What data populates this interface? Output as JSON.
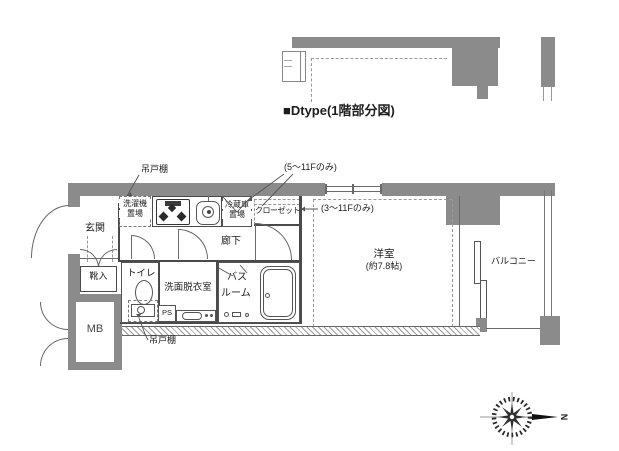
{
  "title": "■Dtype(1階部分図)",
  "colors": {
    "wall": "#8b8b8b",
    "line": "#4a4a4a",
    "accent_ink": "#222222"
  },
  "rooms": {
    "genkan": "玄関",
    "shoe_box": "靴入",
    "meter_box": "MB",
    "toilet": "トイレ",
    "washroom": "洗面脱衣室",
    "bathroom_line1": "バス",
    "bathroom_line2": "ルーム",
    "corridor": "廊下",
    "western_room": "洋室",
    "western_room_size": "(約7.8帖)",
    "balcony": "バルコニー",
    "closet": "クローゼット",
    "fridge_line1": "冷蔵庫",
    "fridge_line2": "置場",
    "washer_line1": "洗濯機",
    "washer_line2": "置場",
    "pipe_space": "PS"
  },
  "annotations": {
    "hanging_cupboard_top": "吊戸棚",
    "hanging_cupboard_bottom": "吊戸棚",
    "floors_5_11": "(5～11Fのみ)",
    "floors_3_11": "(3～11Fのみ)"
  },
  "compass": {
    "north_label": "N"
  }
}
